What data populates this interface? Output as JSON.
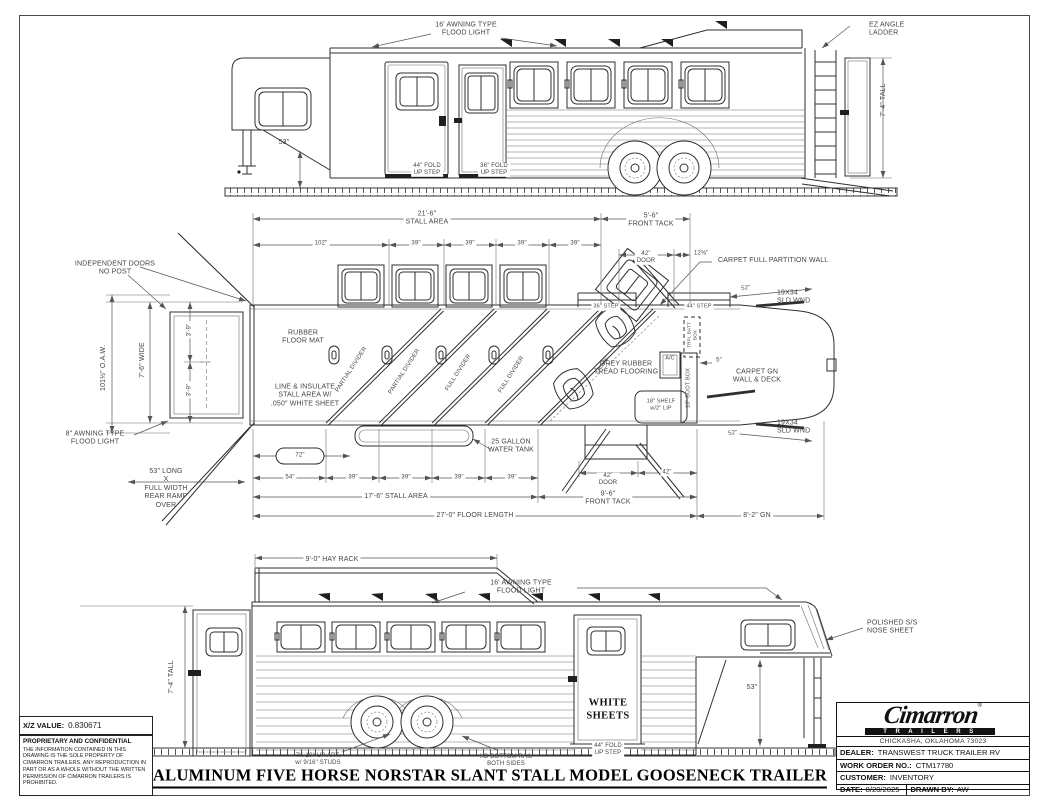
{
  "top": {
    "flood": "16' AWNING TYPE\nFLOOD LIGHT",
    "ladder": "EZ ANGLE\nLADDER",
    "h53": "53\"",
    "tall": "7'-4\" TALL",
    "step44": "44\" FOLD\nUP STEP",
    "step36": "36\" FOLD\nUP STEP"
  },
  "plan": {
    "stall_top": "21'-6\"\nSTALL AREA",
    "tack_top": "5'-6\"\nFRONT TACK",
    "top_row": [
      "102\"",
      "39\"",
      "39\"",
      "39\"",
      "39\""
    ],
    "door_top": "42\"\nDOOR",
    "frac1258": "12⅝\"",
    "partition": "CARPET FULL PARTITION WALL",
    "d52": "52\"",
    "window": "19X34\nSLD WND",
    "indep": "INDEPENDENT DOORS\nNO POST",
    "oaw": "101½\" O.A.W.",
    "wide": "7'-6\" WIDE",
    "d39": "3'-9\"",
    "mat": "RUBBER\nFLOOR MAT",
    "insulate": "LINE & INSULATE\nSTALL AREA W/\n.050\" WHITE SHEET",
    "partial": "PARTIAL DIVIDER",
    "full": "FULL DIVIDER",
    "grey": "GREY RUBBER\nTREAD FLOORING",
    "rows2": "2 ROWS",
    "step36": "36\" STEP",
    "step44": "44\" STEP",
    "tank": "25 GALLON\nWATER TANK",
    "shelf": "18\" SHELF\nw/2\" LIP",
    "boot": "18\" BOOT BOX",
    "batt": "TRPL BATT\nBOX",
    "ac": "A/C",
    "d5": "5\"",
    "gn_wall": "CARPET GN\nWALL & DECK",
    "awning8": "8\" AWNING TYPE\nFLOOD LIGHT",
    "ramp": "53\" LONG\nX\nFULL WIDTH\nREAR RAMP\nOVER",
    "d72": "72\"",
    "bottom_row": [
      "54\"",
      "39\"",
      "39\"",
      "39\"",
      "39\""
    ],
    "stall_bottom": "17'-6\" STALL AREA",
    "floor": "27'-0\" FLOOR LENGTH",
    "door_bottom": "42\"\nDOOR",
    "d42": "42\"",
    "tack_bottom": "9'-6\"\nFRONT TACK",
    "gn82": "8'-2\" GN"
  },
  "bottom": {
    "hay": "9'-0\" HAY RACK",
    "flood": "16' AWNING TYPE\nFLOOD LIGHT",
    "nose": "POLISHED S/S\nNOSE SHEET",
    "tall": "7'-4\" TALL",
    "h53": "53\"",
    "white": "WHITE\nSHEETS",
    "step44": "44\" FOLD\nUP STEP",
    "axle": "7K-10° UP ART.\nw/ 9/16\" STUDS",
    "rail": "HD BOTTOM RAIL\nBOTH SIDES"
  },
  "footer": {
    "title": "ALUMINUM FIVE HORSE NORSTAR SLANT STALL MODEL GOOSENECK TRAILER"
  },
  "info": {
    "xz_label": "X/Z VALUE:",
    "xz_value": "0.830671",
    "conf_title": "PROPRIETARY AND CONFIDENTIAL",
    "conf_text": "THE INFORMATION CONTAINED IN THIS DRAWING IS THE SOLE PROPERTY OF CIMARRON TRAILERS.  ANY REPRODUCTION IN PART OR AS A WHOLE WITHOUT THE WRITTEN PERMISSION OF CIMARRON TRAILERS IS PROHIBITED."
  },
  "block": {
    "brand": "Cimarron",
    "sub": "T R A I L E R S",
    "reg": "®",
    "address": "CHICKASHA, OKLAHOMA 73023",
    "dealer_label": "DEALER:",
    "dealer": "TRANSWEST TRUCK TRAILER RV",
    "wo_label": "WORK ORDER NO.:",
    "wo": "CTM17780",
    "customer_label": "CUSTOMER:",
    "customer": "INVENTORY",
    "date_label": "DATE:",
    "date": "8/20/2025",
    "drawn_label": "DRAWN BY:",
    "drawn": "AW"
  }
}
